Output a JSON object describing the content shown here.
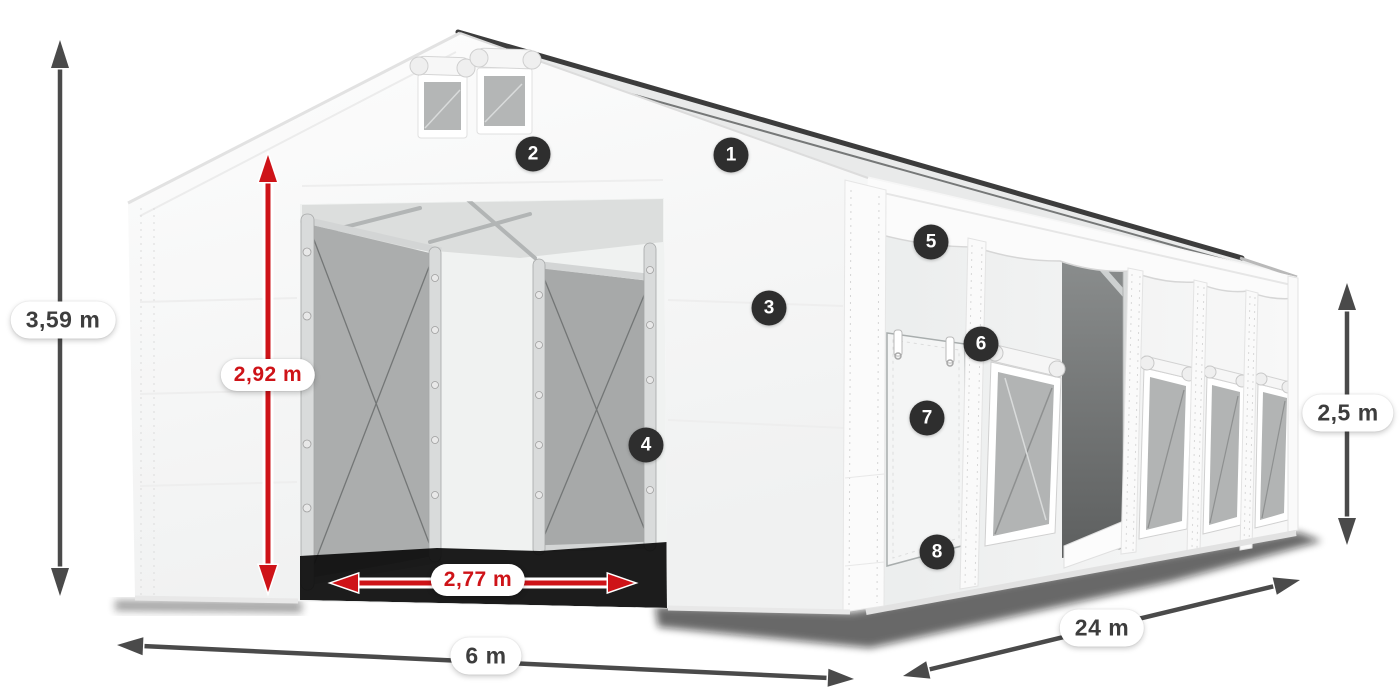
{
  "figure": {
    "illustration_alt": "White storage tent shown in perspective with open gable entrance, interior sliding door frames, side door and mesh windows, annotated with dimensions"
  },
  "dimensions": {
    "total_height": {
      "label": "3,59 m"
    },
    "entrance_height": {
      "label": "2,92 m"
    },
    "entrance_width": {
      "label": "2,77 m"
    },
    "front_width": {
      "label": "6 m"
    },
    "side_length": {
      "label": "24 m"
    },
    "side_wall_height": {
      "label": "2,5 m"
    }
  },
  "callouts": [
    {
      "number": "1"
    },
    {
      "number": "2"
    },
    {
      "number": "3"
    },
    {
      "number": "4"
    },
    {
      "number": "5"
    },
    {
      "number": "6"
    },
    {
      "number": "7"
    },
    {
      "number": "8"
    }
  ],
  "colors": {
    "dimension_red": "#ce1318",
    "arrow_dark": "#4a4a4a",
    "badge_background": "#2e2e2e",
    "badge_text": "#ffffff",
    "tent_white": "#f7f7f7",
    "mesh_gray": "#b2b4b4"
  }
}
